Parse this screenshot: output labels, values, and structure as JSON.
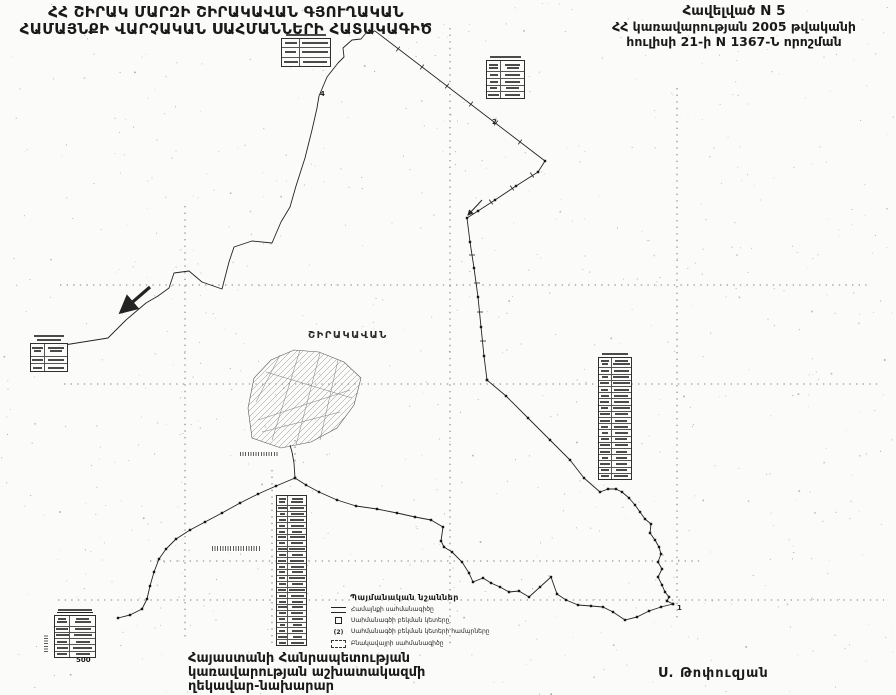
{
  "header": {
    "title_line1": "ՀՀ ՇԻՐԱԿ ՄԱՐԶԻ ՇԻՐԱԿԱՎԱՆ ԳՅՈՒՂԱԿԱՆ",
    "title_line2": "ՀԱՄԱՅՆՔԻ ՎԱՐՉԱԿԱՆ ՍԱՀՄԱՆՆԵՐԻ ՀԱՏԱԿԱԳԻԾ",
    "appendix_line1": "Հավելված N 5",
    "appendix_line2": "ՀՀ կառավարության 2005 թվականի",
    "appendix_line3": "հուլիսի 21-ի N 1367-Ն որոշման"
  },
  "footer": {
    "left_line1": "Հայաստանի Հանրապետության",
    "left_line2": "կառավարության աշխատակազմի",
    "left_line3": "ղեկավար-նախարար",
    "signature": "Ս. Թոփուզյան"
  },
  "map": {
    "settlement_label": "ՇԻՐԱԿԱՎԱՆ",
    "scale_label": "500",
    "ink_color": "#232323",
    "point_labels": [
      {
        "t": "2",
        "x": 492,
        "y": 118
      },
      {
        "t": "4",
        "x": 320,
        "y": 90
      },
      {
        "t": "1",
        "x": 677,
        "y": 604
      }
    ],
    "legend": {
      "title": "Պայմանական նշաններ",
      "items": [
        {
          "symbol": "double-line",
          "label": "Համայնքի սահմանագիծը"
        },
        {
          "symbol": "point-square",
          "label": "Սահմանագծի բեկման կետերը"
        },
        {
          "symbol": "circled-number",
          "label": "Սահմանագծի բեկման կետերի համարները"
        },
        {
          "symbol": "dashed-box",
          "label": "Բնակավայրի սահմանագիծը"
        }
      ]
    },
    "tables": [
      {
        "name": "coordinate-table-north",
        "x": 281,
        "y": 34,
        "w": 50,
        "h": 27,
        "rows": 3,
        "title_lines": 1,
        "header": false
      },
      {
        "name": "coordinate-table-northeast",
        "x": 486,
        "y": 56,
        "w": 39,
        "h": 37,
        "rows": 4,
        "title_lines": 1,
        "header": true
      },
      {
        "name": "coordinate-table-west",
        "x": 30,
        "y": 335,
        "w": 38,
        "h": 27,
        "rows": 2,
        "title_lines": 2,
        "header": true
      },
      {
        "name": "coordinate-table-east",
        "x": 598,
        "y": 353,
        "w": 34,
        "h": 121,
        "rows": 18,
        "title_lines": 1,
        "header": true
      },
      {
        "name": "coordinate-table-south",
        "x": 276,
        "y": 495,
        "w": 31,
        "h": 149,
        "rows": 24,
        "title_lines": 0,
        "header": true
      },
      {
        "name": "coordinate-table-southwest",
        "x": 54,
        "y": 609,
        "w": 42,
        "h": 41,
        "rows": 5,
        "title_lines": 1,
        "underline_title": true,
        "header": true
      }
    ],
    "grid_lines": [
      [
        185,
        206,
        185,
        641
      ],
      [
        450,
        28,
        450,
        646
      ],
      [
        677,
        88,
        677,
        622
      ],
      [
        272,
        470,
        272,
        648
      ],
      [
        295,
        440,
        295,
        464
      ],
      [
        60,
        285,
        868,
        285
      ],
      [
        64,
        384,
        880,
        384
      ],
      [
        150,
        561,
        702,
        561
      ],
      [
        58,
        600,
        884,
        600
      ]
    ],
    "boundaries": {
      "west": [
        [
          58,
          346
        ],
        [
          108,
          338
        ],
        [
          126,
          320
        ],
        [
          146,
          303
        ],
        [
          158,
          296
        ],
        [
          169,
          288
        ],
        [
          174,
          273
        ],
        [
          189,
          271
        ],
        [
          202,
          282
        ],
        [
          222,
          289
        ],
        [
          229,
          262
        ],
        [
          234,
          247
        ],
        [
          252,
          241
        ],
        [
          272,
          243
        ],
        [
          281,
          222
        ],
        [
          290,
          207
        ],
        [
          296,
          186
        ],
        [
          305,
          158
        ],
        [
          312,
          130
        ],
        [
          317,
          108
        ],
        [
          319,
          96
        ],
        [
          327,
          77
        ],
        [
          338,
          63
        ],
        [
          344,
          57
        ],
        [
          343,
          48
        ],
        [
          352,
          40
        ],
        [
          361,
          39
        ],
        [
          366,
          33
        ],
        [
          375,
          31
        ]
      ],
      "northeast": [
        [
          375,
          31
        ],
        [
          545,
          161
        ]
      ],
      "east": [
        [
          545,
          161
        ],
        [
          538,
          172
        ],
        [
          516,
          186
        ],
        [
          495,
          200
        ],
        [
          478,
          211
        ],
        [
          467,
          218
        ],
        [
          470,
          242
        ],
        [
          474,
          268
        ],
        [
          478,
          297
        ],
        [
          481,
          327
        ],
        [
          484,
          356
        ],
        [
          487,
          380
        ]
      ],
      "southeast": [
        [
          487,
          380
        ],
        [
          506,
          396
        ],
        [
          528,
          418
        ],
        [
          550,
          440
        ],
        [
          570,
          460
        ],
        [
          584,
          478
        ],
        [
          600,
          492
        ],
        [
          608,
          489
        ],
        [
          616,
          489
        ],
        [
          622,
          492
        ],
        [
          629,
          498
        ],
        [
          635,
          505
        ],
        [
          640,
          512
        ],
        [
          645,
          519
        ],
        [
          651,
          524
        ],
        [
          650,
          533
        ],
        [
          655,
          540
        ],
        [
          659,
          547
        ],
        [
          661,
          554
        ],
        [
          658,
          562
        ],
        [
          662,
          569
        ],
        [
          658,
          577
        ],
        [
          662,
          585
        ],
        [
          665,
          592
        ],
        [
          669,
          597
        ],
        [
          667,
          601
        ],
        [
          673,
          604
        ]
      ],
      "south": [
        [
          673,
          604
        ],
        [
          661,
          607
        ],
        [
          649,
          611
        ],
        [
          637,
          617
        ],
        [
          625,
          620
        ],
        [
          613,
          612
        ],
        [
          603,
          607
        ],
        [
          591,
          606
        ],
        [
          578,
          605
        ],
        [
          566,
          600
        ],
        [
          557,
          594
        ],
        [
          551,
          577
        ],
        [
          540,
          587
        ],
        [
          529,
          597
        ],
        [
          519,
          591
        ],
        [
          509,
          592
        ],
        [
          500,
          587
        ],
        [
          491,
          583
        ],
        [
          483,
          578
        ],
        [
          473,
          582
        ],
        [
          469,
          573
        ],
        [
          462,
          562
        ],
        [
          452,
          552
        ],
        [
          444,
          547
        ],
        [
          441,
          541
        ],
        [
          443,
          527
        ],
        [
          431,
          520
        ],
        [
          415,
          517
        ],
        [
          397,
          513
        ],
        [
          377,
          509
        ],
        [
          356,
          506
        ],
        [
          337,
          500
        ],
        [
          319,
          492
        ],
        [
          306,
          485
        ],
        [
          295,
          478
        ]
      ],
      "southwest": [
        [
          295,
          478
        ],
        [
          276,
          486
        ],
        [
          258,
          494
        ],
        [
          240,
          503
        ],
        [
          222,
          513
        ],
        [
          205,
          522
        ],
        [
          190,
          530
        ],
        [
          176,
          539
        ],
        [
          166,
          549
        ],
        [
          159,
          559
        ],
        [
          154,
          572
        ],
        [
          150,
          586
        ],
        [
          147,
          599
        ],
        [
          142,
          609
        ],
        [
          130,
          615
        ],
        [
          118,
          618
        ]
      ],
      "settlement_link": [
        [
          295,
          478
        ],
        [
          294,
          463
        ],
        [
          292,
          452
        ],
        [
          290,
          445
        ]
      ]
    },
    "settlement_outline": [
      [
        252,
        438
      ],
      [
        248,
        408
      ],
      [
        254,
        378
      ],
      [
        271,
        360
      ],
      [
        294,
        350
      ],
      [
        319,
        352
      ],
      [
        344,
        362
      ],
      [
        361,
        378
      ],
      [
        354,
        405
      ],
      [
        337,
        428
      ],
      [
        311,
        442
      ],
      [
        281,
        448
      ]
    ],
    "settlement_parcels": [
      [
        258,
        420,
        350,
        390
      ],
      [
        262,
        432,
        340,
        412
      ],
      [
        266,
        372,
        352,
        398
      ],
      [
        280,
        355,
        256,
        402
      ],
      [
        300,
        350,
        272,
        440
      ],
      [
        320,
        353,
        296,
        445
      ],
      [
        338,
        360,
        320,
        440
      ]
    ],
    "ticks": [
      [
        398,
        49,
        128
      ],
      [
        422,
        67,
        128
      ],
      [
        447,
        86,
        128
      ],
      [
        471,
        104,
        128
      ],
      [
        496,
        123,
        128
      ],
      [
        520,
        142,
        128
      ],
      [
        532,
        175,
        53
      ],
      [
        512,
        188,
        53
      ],
      [
        491,
        202,
        53
      ],
      [
        472,
        255,
        0
      ],
      [
        477,
        283,
        0
      ],
      [
        480,
        312,
        0
      ],
      [
        483,
        341,
        0
      ]
    ],
    "arrows": [
      [
        150,
        287,
        121,
        312,
        3.2
      ],
      [
        482,
        200,
        468,
        215,
        1
      ]
    ],
    "illegible_labels": [
      {
        "x": 240,
        "y": 452,
        "w": 38,
        "h": 4,
        "vertical": false
      },
      {
        "x": 212,
        "y": 546,
        "w": 48,
        "h": 5,
        "vertical": false
      },
      {
        "x": 44,
        "y": 634,
        "w": 4,
        "h": 18,
        "vertical": true
      }
    ]
  }
}
